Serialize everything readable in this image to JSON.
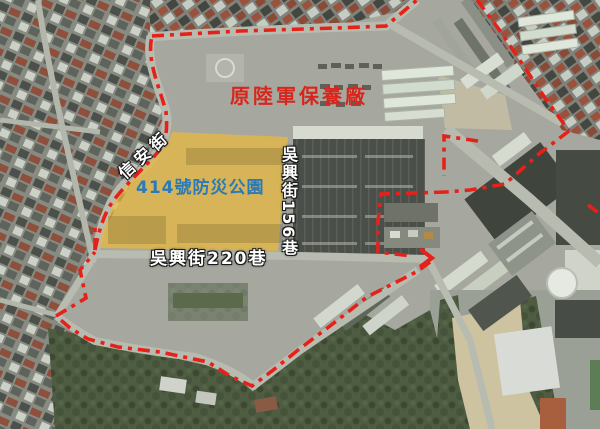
{
  "labels": {
    "former_army_depot": {
      "text": "原陸軍保養廠",
      "color": "#d9261c"
    },
    "park_414": {
      "text": "414號防災公園",
      "color": "#2b7ab8"
    },
    "xinan_street": {
      "text": "信安街",
      "color": "#ffffff"
    },
    "wuxing_lane_156": {
      "text": "吳興街156巷",
      "color": "#ffffff"
    },
    "wuxing_lane_220": {
      "text": "吳興街220巷",
      "color": "#ffffff"
    }
  },
  "overlay": {
    "boundary_color": "#e62119",
    "park_fill": "#e9b93b"
  }
}
